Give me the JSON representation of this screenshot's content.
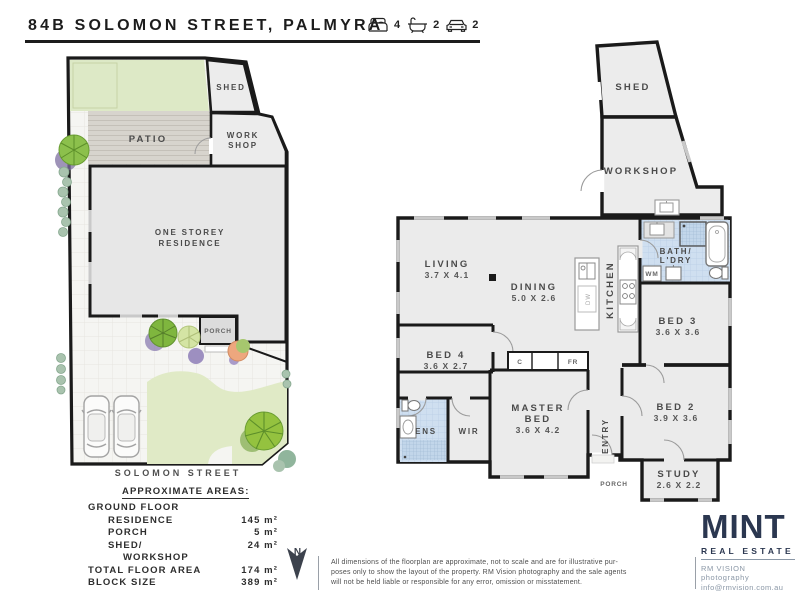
{
  "header": {
    "title": "84B SOLOMON STREET, PALMYRA",
    "stats": [
      {
        "icon": "bed-icon",
        "value": "4"
      },
      {
        "icon": "bath-icon",
        "value": "2"
      },
      {
        "icon": "car-icon",
        "value": "2"
      }
    ]
  },
  "site_plan": {
    "patio": "PATIO",
    "shed": "SHED",
    "workshop_line1": "WORK",
    "workshop_line2": "SHOP",
    "residence_line1": "ONE STOREY",
    "residence_line2": "RESIDENCE",
    "porch": "PORCH",
    "street": "SOLOMON STREET"
  },
  "floor_plan": {
    "rooms": {
      "shed": {
        "name": "SHED"
      },
      "workshop": {
        "name": "WORKSHOP"
      },
      "living": {
        "name": "LIVING",
        "dims": "3.7 X 4.1"
      },
      "dining": {
        "name": "DINING",
        "dims": "5.0 X 2.6"
      },
      "kitchen": {
        "name": "KITCHEN"
      },
      "bath_laundry": {
        "line1": "BATH/",
        "line2": "L'DRY"
      },
      "bed3": {
        "name": "BED 3",
        "dims": "3.6 X 3.6"
      },
      "bed4": {
        "name": "BED 4",
        "dims": "3.6 X 2.7"
      },
      "master": {
        "line1": "MASTER",
        "line2": "BED",
        "dims": "3.6 X 4.2"
      },
      "wir": {
        "name": "WIR"
      },
      "ens": {
        "name": "ENS"
      },
      "entry": {
        "name": "ENTRY"
      },
      "bed2": {
        "name": "BED 2",
        "dims": "3.9 X 3.6"
      },
      "study": {
        "name": "STUDY",
        "dims": "2.6 X 2.2"
      },
      "porch": {
        "name": "PORCH"
      }
    },
    "fixtures": {
      "wm": "WM",
      "dw": "DW",
      "cupboard": "C",
      "fridge": "FR"
    }
  },
  "areas": {
    "heading": "APPROXIMATE AREAS:",
    "rows": [
      {
        "label": "GROUND FLOOR",
        "value": ""
      },
      {
        "label": "RESIDENCE",
        "value": "145 m²"
      },
      {
        "label": "PORCH",
        "value": "5 m²"
      },
      {
        "label": "SHED/\n    WORKSHOP",
        "value": "24 m²"
      },
      {
        "label": "TOTAL FLOOR AREA",
        "value": "174 m²"
      },
      {
        "label": "BLOCK SIZE",
        "value": "389 m²"
      }
    ]
  },
  "compass": {
    "label": "N"
  },
  "disclaimer": "All dimensions of the floorplan are approximate, not to scale and are for illustrative pur-\nposes only to show the layout of the property. RM Vision photography and the sale agents\nwill not be held liable or responsible for any error, omission or misstatement.",
  "branding": {
    "logo": "MINT",
    "tagline": "REAL ESTATE",
    "photography": "RM VISION photography",
    "email": "info@rmvision.com.au"
  },
  "colors": {
    "wall": "#1a1a1a",
    "room_fill": "#ebebeb",
    "wet_area": "#cfdff0",
    "lawn": "#dde9c6",
    "patio": "#d7d4cd",
    "paving": "#f5f5f2",
    "brand_navy": "#2b3750",
    "label_gray": "#4a4a4a"
  }
}
